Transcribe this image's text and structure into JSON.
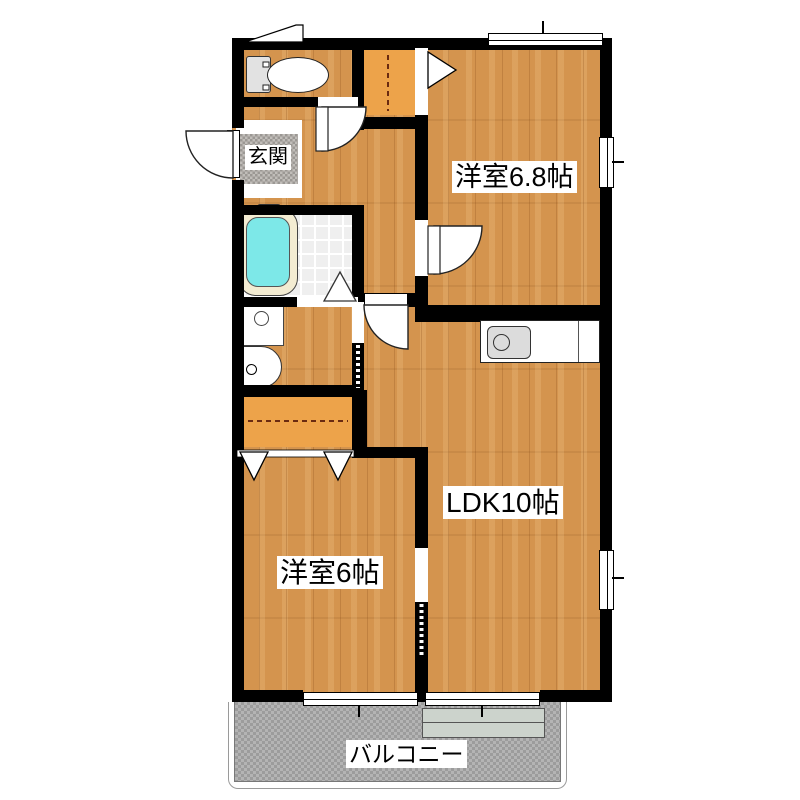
{
  "plan": {
    "rooms": {
      "western_room_68": "洋室6.8帖",
      "ldk": "LDK10帖",
      "western_room_6": "洋室6帖",
      "entrance": "玄関",
      "balcony": "バルコニー"
    },
    "colors": {
      "wall": "#000000",
      "wood_floor": "#d4944e",
      "closet": "#eda34a",
      "bath_tile": "#efefef",
      "bathtub_water": "#7de8e8",
      "bathtub_rim": "#f3ecd2",
      "balcony_floor": "#a9a9a9",
      "entrance_mat": "#b0ada9",
      "step": "#ccd3cc"
    },
    "fixtures": [
      "toilet",
      "bathtub",
      "washbasin",
      "washing-machine-pan",
      "kitchen-sink"
    ]
  }
}
